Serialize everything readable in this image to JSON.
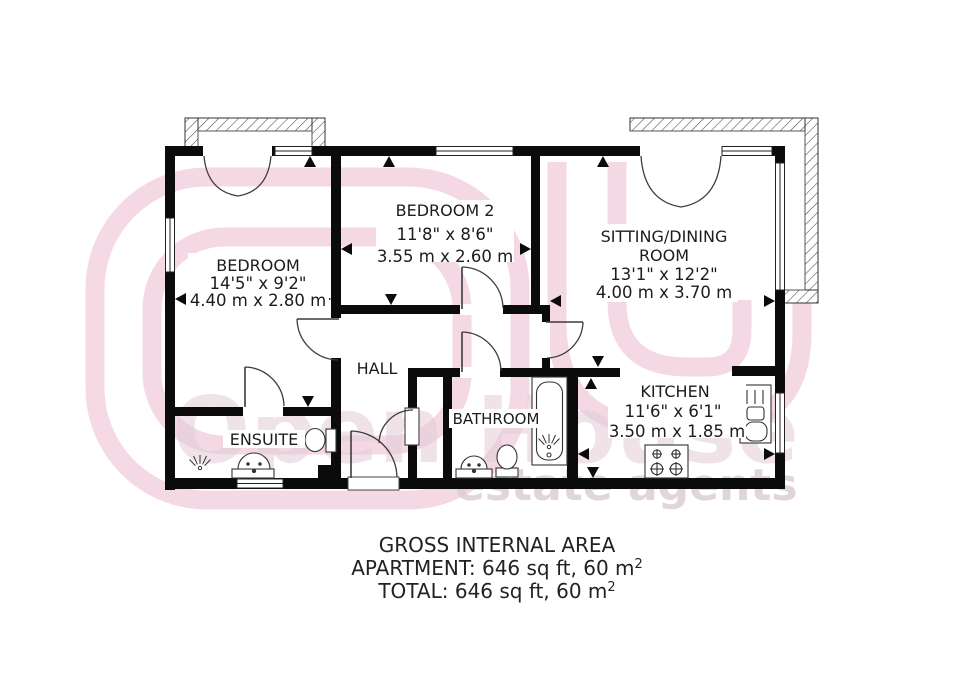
{
  "title": "Apartment floor plan",
  "rooms": [
    {
      "id": "bedroom",
      "name": "BEDROOM",
      "dim_imperial": "14'5\" x 9'2\"",
      "dim_metric": "4.40 m x 2.80 m"
    },
    {
      "id": "bedroom2",
      "name": "BEDROOM 2",
      "dim_imperial": "11'8\" x 8'6\"",
      "dim_metric": "3.55 m x 2.60 m"
    },
    {
      "id": "sitting",
      "name": "SITTING/DINING",
      "name_line2": "ROOM",
      "dim_imperial": "13'1\" x 12'2\"",
      "dim_metric": "4.00 m x 3.70 m"
    },
    {
      "id": "kitchen",
      "name": "KITCHEN",
      "dim_imperial": "11'6\" x 6'1\"",
      "dim_metric": "3.50 m x 1.85 m"
    },
    {
      "id": "bathroom",
      "name": "BATHROOM"
    },
    {
      "id": "ensuite",
      "name": "ENSUITE"
    },
    {
      "id": "hall",
      "name": "HALL"
    }
  ],
  "summary": {
    "line1": "GROSS INTERNAL AREA",
    "line2": "APARTMENT: 646 sq ft, 60 m",
    "line3": "TOTAL: 646 sq ft, 60 m",
    "sup": "2"
  },
  "watermark": {
    "brand": "Open House",
    "tagline": "estate agents"
  },
  "fixtures": [
    "shower-spray",
    "bathtub",
    "toilet",
    "pedestal-sink",
    "hob",
    "kitchen-sink"
  ],
  "colors": {
    "wall": "#0b0b0b",
    "line": "#3c3c3c",
    "text": "#1c1c1c",
    "watermark_pink": "#f3d3e1",
    "watermark_text": "#e3cdd8",
    "watermark_gray": "#d9ccd2"
  }
}
